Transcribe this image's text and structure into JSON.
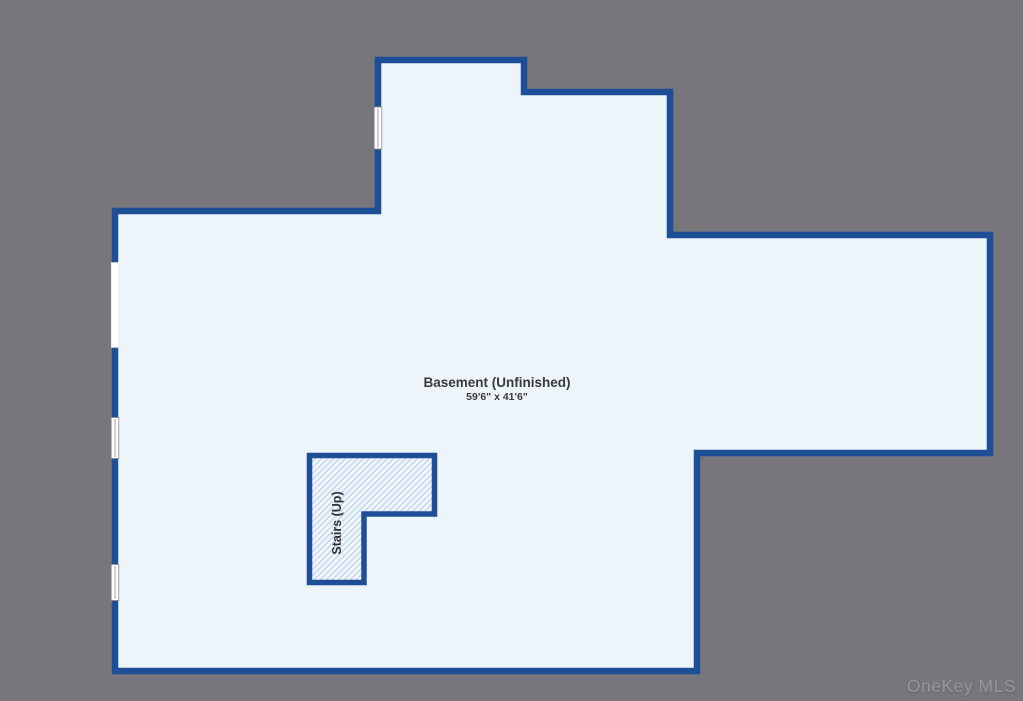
{
  "floorplan": {
    "room_label": "Basement (Unfinished)",
    "room_dimensions": "59'6\" x 41'6\"",
    "stairs_label": "Stairs (Up)"
  },
  "watermark": "OneKey MLS",
  "colors": {
    "background": "#77777b",
    "wall": "#1e4e96",
    "floor": "#edf5fb",
    "stairs_hatch_bg": "#f1f7fc",
    "stairs_hatch_line": "#c9daeb",
    "window_fill": "#ffffff",
    "window_frame": "#8a8a8a",
    "label_text": "#3a3a3a",
    "watermark_text": "#96969b"
  },
  "icons": {
    "window_icon": "double-pane window symbol (white bar with center line)",
    "wall_opening": "plain white gap in wall"
  }
}
